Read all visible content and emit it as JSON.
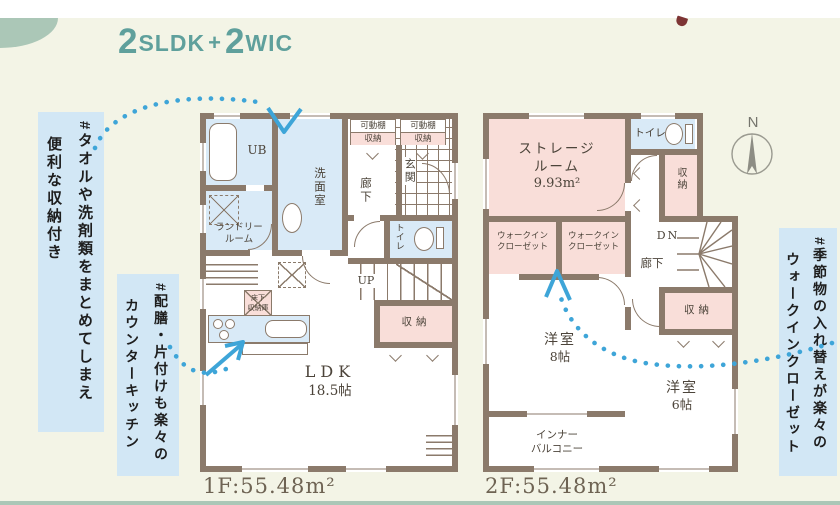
{
  "title": {
    "n1": "2",
    "u1": "SLDK",
    "plus": "+",
    "n2": "2",
    "u2": "WIC"
  },
  "notes": {
    "laundry": {
      "l1": "#タオルや洗剤類をまとめてしまえ",
      "l2": "便利な収納付き"
    },
    "kitchen": {
      "l1": "#配膳・片付けも楽々の",
      "l2": "カウンターキッチン"
    },
    "wic": {
      "l1": "#季節物の入れ替えが楽々の",
      "l2": "ウォークインクローゼット"
    }
  },
  "f1": {
    "ub": "UB",
    "senmen": "洗面室",
    "laundry_l1": "ランドリー",
    "laundry_l2": "ルーム",
    "shelf_l1": "可動棚",
    "shelf_l2": "収納",
    "hall": "廊下",
    "genkan": "玄関",
    "toilet": "トイレ",
    "up": "UP",
    "storage": "収納",
    "floor_storage_l1": "床下",
    "floor_storage_l2": "収納庫",
    "ldk": "LDK",
    "ldk_size": "18.5帖",
    "area": "1F:55.48m²"
  },
  "f2": {
    "storage_room_l1": "ストレージ",
    "storage_room_l2": "ルーム",
    "storage_room_size": "9.93m²",
    "toilet": "トイレ",
    "closet_upper": "収納",
    "wic_l1": "ウォークイン",
    "wic_l2": "クローゼット",
    "dn": "DN",
    "hall": "廊下",
    "closet_lower": "収納",
    "room8_l1": "洋室",
    "room8_l2": "8帖",
    "room6_l1": "洋室",
    "room6_l2": "6帖",
    "balcony_l1": "インナー",
    "balcony_l2": "バルコニー",
    "area": "2F:55.48m²"
  },
  "compass": {
    "n": "N"
  },
  "colors": {
    "background": "#f3f4e6",
    "wall": "#8b7a6b",
    "room_blue": "#d9eaf7",
    "room_pink": "#f9ded9",
    "note_bg": "#d2e7f5",
    "arrow_blue": "#3ea5d8",
    "title_teal": "#5fa09c",
    "accent_green": "#abc7b7",
    "text_dark": "#4c443a"
  }
}
